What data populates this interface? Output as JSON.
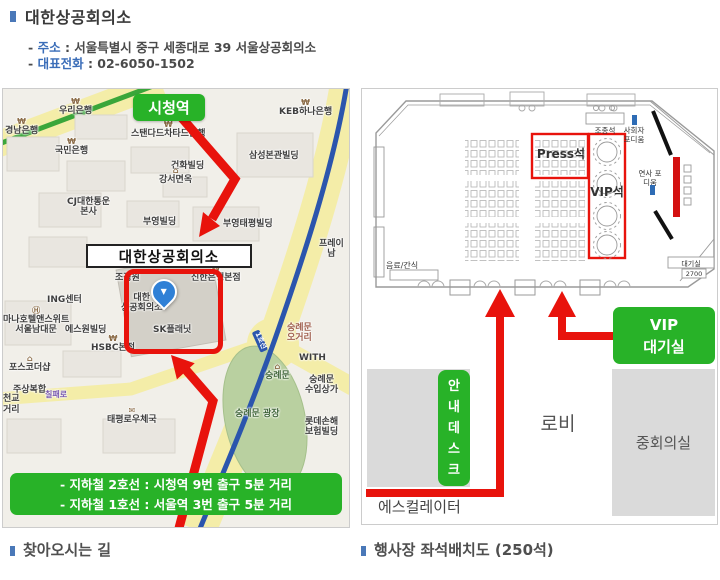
{
  "header": {
    "title": "대한상공회의소",
    "line1_pre": "-",
    "line1_label": "주소",
    "line1_rest": ": 서울특별시 중구 세종대로 39 서울상공회의소",
    "line2_pre": "-",
    "line2_label": "대표전화",
    "line2_rest": ": 02-6050-1502"
  },
  "map": {
    "station_badge": "시청역",
    "building_label": "대한상공회의소",
    "pin_glyph": "▼",
    "subway_line1": "- 지하철 2호선 : 시청역 9번 출구 5분 거리",
    "subway_line2": "- 지하철 1호선 : 서울역 3번 출구 5분 거리",
    "labels": [
      {
        "t": "경남은행",
        "x": 2,
        "y": 29,
        "icon": "₩"
      },
      {
        "t": "우리은행",
        "x": 56,
        "y": 9,
        "icon": "₩"
      },
      {
        "t": "KEB하나은행",
        "x": 276,
        "y": 10,
        "icon": "₩"
      },
      {
        "t": "스탠다드차타드은행",
        "x": 128,
        "y": 32,
        "icon": "₩"
      },
      {
        "t": "국민은행",
        "x": 52,
        "y": 49,
        "icon": "₩"
      },
      {
        "t": "삼성본관빌딩",
        "x": 246,
        "y": 62
      },
      {
        "t": "건화빌딩",
        "x": 168,
        "y": 72
      },
      {
        "t": "강서면옥",
        "x": 156,
        "y": 78,
        "icon": "⌂"
      },
      {
        "t": "CJ대한통운\n본사",
        "x": 64,
        "y": 108
      },
      {
        "t": "부영빌딩",
        "x": 140,
        "y": 128
      },
      {
        "t": "부영태평빌딩",
        "x": 220,
        "y": 130
      },
      {
        "t": "프레이\n남",
        "x": 316,
        "y": 150
      },
      {
        "t": "조정원",
        "x": 112,
        "y": 184
      },
      {
        "t": "신한은행본점",
        "x": 188,
        "y": 176,
        "icon": "₩"
      },
      {
        "t": "ING센터",
        "x": 44,
        "y": 206
      },
      {
        "t": "대한\n상공회의소",
        "x": 118,
        "y": 204
      },
      {
        "t": "SK플래닛",
        "x": 150,
        "y": 236
      },
      {
        "t": "마나호텔앤스위트\n서울남대문",
        "x": 0,
        "y": 218,
        "icon": "Ⓗ"
      },
      {
        "t": "에스원빌딩",
        "x": 62,
        "y": 236
      },
      {
        "t": "HSBC본점",
        "x": 88,
        "y": 246,
        "icon": "₩"
      },
      {
        "t": "포스코더샵",
        "x": 6,
        "y": 266,
        "icon": "⌂"
      },
      {
        "t": "주상복합",
        "x": 10,
        "y": 296
      },
      {
        "t": "칠패로",
        "x": 42,
        "y": 302,
        "cls": "road"
      },
      {
        "t": "천교",
        "x": 0,
        "y": 305
      },
      {
        "t": "거리",
        "x": 0,
        "y": 316
      },
      {
        "t": "태평로우체국",
        "x": 104,
        "y": 318,
        "icon": "✉"
      },
      {
        "t": "숭례문\n오거리",
        "x": 284,
        "y": 234,
        "cls": "area"
      },
      {
        "t": "WITH",
        "x": 296,
        "y": 264
      },
      {
        "t": "숭례문",
        "x": 262,
        "y": 274,
        "icon": "⌂",
        "cls": "park"
      },
      {
        "t": "숭례문 광장",
        "x": 232,
        "y": 320,
        "cls": "park"
      },
      {
        "t": "숭례문\n수입상가",
        "x": 302,
        "y": 286
      },
      {
        "t": "롯데손해\n보험빌딩",
        "x": 302,
        "y": 328
      },
      {
        "t": "1호선",
        "x": 246,
        "y": 248,
        "cls": "linebadge"
      }
    ]
  },
  "seating": {
    "control": "조종석",
    "press": "Press석",
    "vip": "VIP석",
    "mc_podium": "사회자 포디움",
    "speaker_podium": "연사 포디움",
    "drinks": "음료/간식",
    "waiting_room": "대기실",
    "dimension": "2700",
    "vip_waiting_line1": "VIP",
    "vip_waiting_line2": "대기실",
    "info_desk": "안내데스크",
    "lobby": "로비",
    "mid_room": "중회의실",
    "escalator": "에스컬레이터"
  },
  "captions": {
    "left": "찾아오시는 길",
    "right": "행사장 좌석배치도 (250석)"
  },
  "colors": {
    "accent_green": "#28b228",
    "accent_red": "#e8130c",
    "bullet_blue": "#4a78b8",
    "label_blue": "#3a6db8"
  }
}
